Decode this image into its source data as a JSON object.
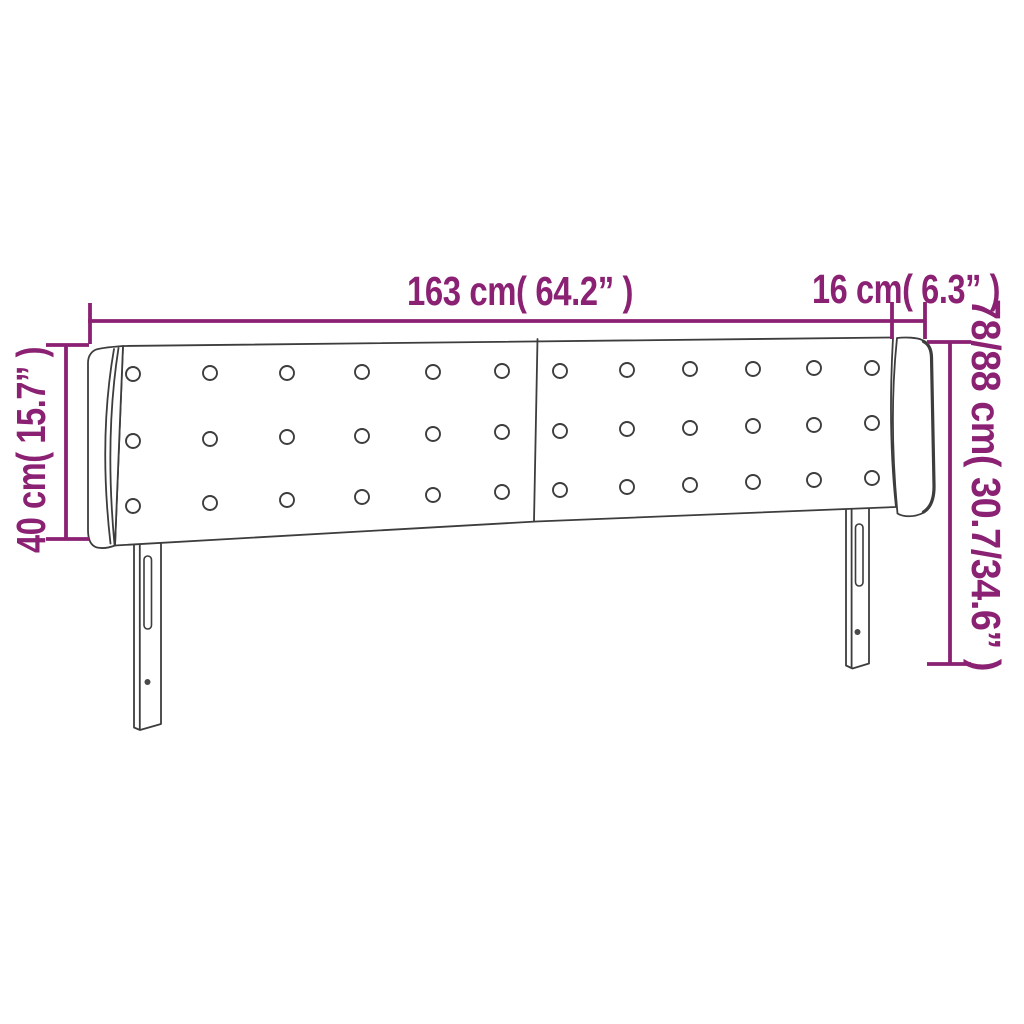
{
  "diagram": {
    "kind": "product-dimension-diagram",
    "subject": "winged upholstered headboard with two slotted legs and button tufting",
    "colors": {
      "dimension_accent": "#8B2173",
      "line_art": "#3D3D3D",
      "background": "#FFFFFF"
    },
    "labels": {
      "total_width": "163 cm( 64.2” )",
      "wing_depth": "16 cm( 6.3” )",
      "panel_height": "40 cm( 15.7” )",
      "total_height": "78/88 cm( 30.7/34.6” )"
    },
    "tufting_buttons": {
      "count": 36,
      "radius": 7,
      "positions": [
        [
          133,
          374
        ],
        [
          210,
          373
        ],
        [
          287,
          373
        ],
        [
          362,
          372
        ],
        [
          433,
          372
        ],
        [
          502,
          371
        ],
        [
          560,
          371
        ],
        [
          627,
          370
        ],
        [
          690,
          369
        ],
        [
          753,
          369
        ],
        [
          814,
          368
        ],
        [
          872,
          368
        ],
        [
          133,
          441
        ],
        [
          210,
          439
        ],
        [
          287,
          437
        ],
        [
          362,
          436
        ],
        [
          433,
          434
        ],
        [
          502,
          432
        ],
        [
          560,
          431
        ],
        [
          627,
          429
        ],
        [
          690,
          428
        ],
        [
          753,
          426
        ],
        [
          814,
          425
        ],
        [
          872,
          423
        ],
        [
          133,
          506
        ],
        [
          210,
          503
        ],
        [
          287,
          500
        ],
        [
          362,
          497
        ],
        [
          433,
          495
        ],
        [
          502,
          492
        ],
        [
          560,
          490
        ],
        [
          627,
          487
        ],
        [
          690,
          485
        ],
        [
          753,
          482
        ],
        [
          814,
          480
        ],
        [
          872,
          478
        ]
      ]
    }
  }
}
